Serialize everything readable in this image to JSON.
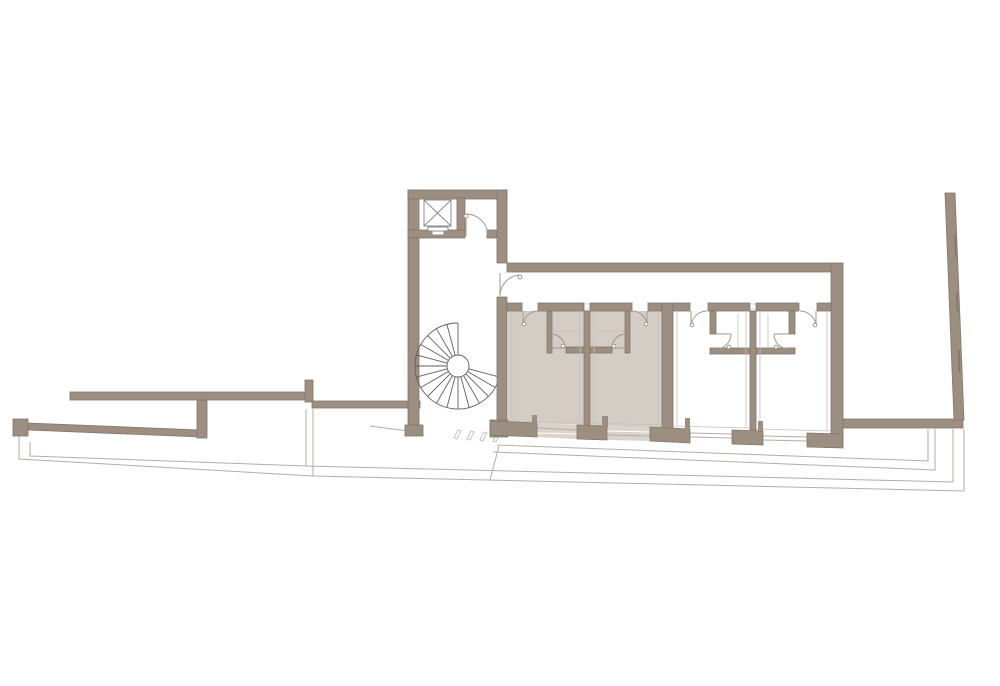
{
  "figure": {
    "type": "architectural-floor-plan",
    "background": "#ffffff",
    "highlighted_room_count": 2,
    "room_count": 4
  },
  "colors": {
    "bg": "#ffffff",
    "wall": "#9c8e80",
    "wall-outline": "#84776a",
    "room-highlight": "#d4cdc5",
    "glazing-highlight": "#d9d3cb",
    "line-thin": "#b3ada5",
    "line-detail": "#c6c0b9",
    "line-door": "#9e9a93",
    "line-stair": "#5f5f5f",
    "line-lift": "#8c8c8c",
    "hatch": "#c9c4bd"
  },
  "elements": {
    "tower": [
      "elevator-shaft",
      "elevator-car",
      "lobby-door",
      "spiral-stair",
      "threshold-hatch"
    ],
    "wing": [
      "corridor",
      "room-1-highlighted",
      "room-2-highlighted",
      "room-3",
      "room-4",
      "bathroom-1",
      "bathroom-2",
      "bathroom-3",
      "bathroom-4",
      "entry-doors",
      "window-piers",
      "glazing-bays"
    ],
    "site": [
      "left-garden-wall-upper",
      "left-garden-wall-lower",
      "terrace-step-lines",
      "right-courtyard-wall",
      "freestanding-slanted-wall"
    ]
  }
}
